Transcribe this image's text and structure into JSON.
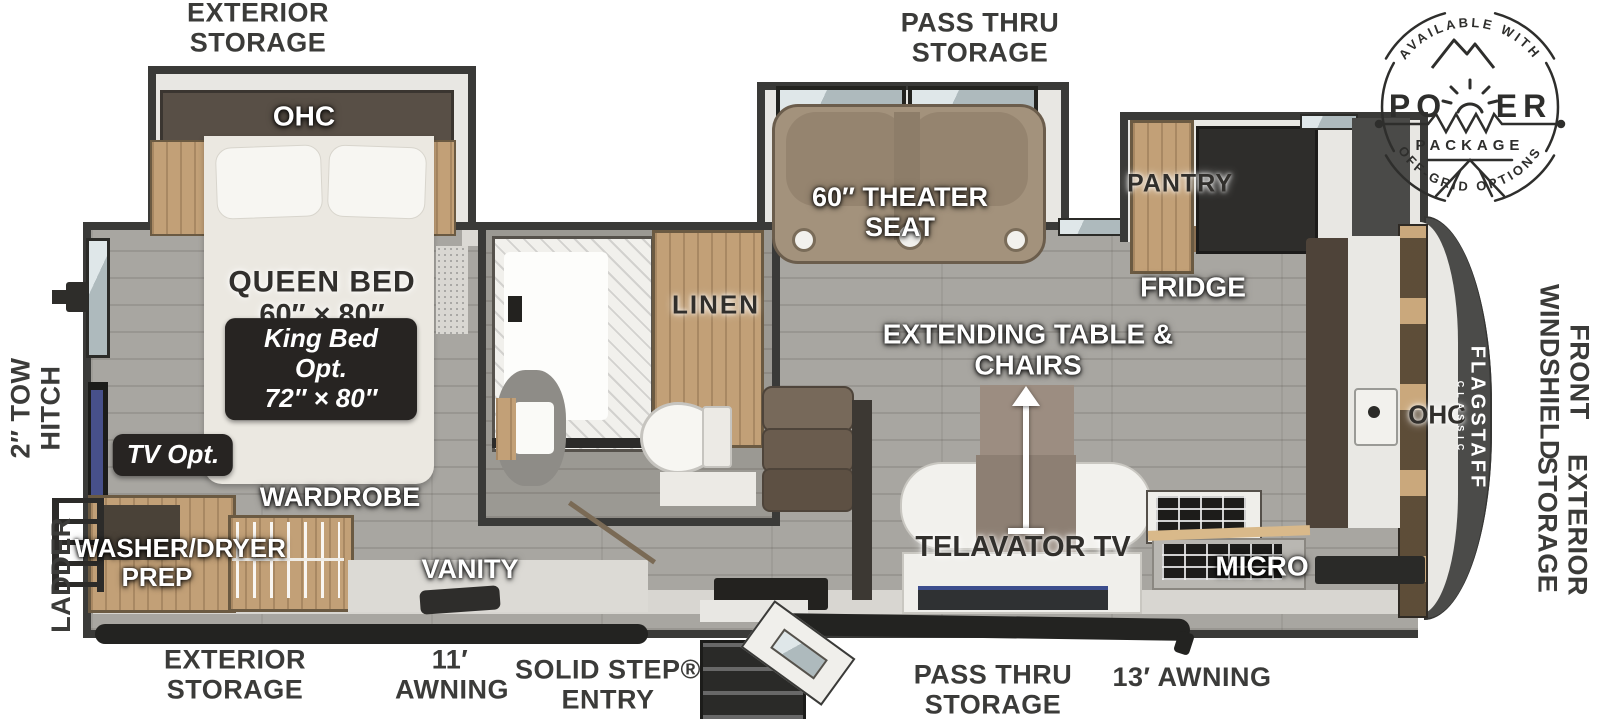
{
  "power_badge": {
    "arc_top": "AVAILABLE WITH",
    "word_left": "PO",
    "word_right": "ER",
    "package": "PACKAGE",
    "arc_bottom": "OFF-GRID OPTIONS"
  },
  "brand": {
    "name": "FLAGSTAFF",
    "series": "CLASSIC"
  },
  "exterior_labels": {
    "storage_top_left": "EXTERIOR STORAGE",
    "pass_thru_top": "PASS THRU STORAGE",
    "tow_hitch": "2″ TOW HITCH",
    "ladder": "LADDER",
    "front_windshield": "FRONT WINDSHIELD",
    "exterior_storage_right": "EXTERIOR STORAGE",
    "exterior_storage_bottom": "EXTERIOR STORAGE",
    "awning_11": "11′ AWNING",
    "solid_step_entry": "SOLID STEP® ENTRY",
    "pass_thru_bottom": "PASS THRU STORAGE",
    "awning_13": "13′ AWNING"
  },
  "bedroom": {
    "ohc": "OHC",
    "bed_name": "QUEEN BED",
    "bed_size": "60″ × 80″",
    "king_option_name": "King Bed Opt.",
    "king_option_size": "72″ × 80″",
    "tv_option": "TV Opt.",
    "wardrobe": "WARDROBE",
    "washer_dryer_prep": "WASHER/DRYER PREP"
  },
  "bathroom": {
    "linen": "LINEN",
    "vanity": "VANITY"
  },
  "living_area": {
    "theater_seat": "60″ THEATER SEAT",
    "extending_table": "EXTENDING TABLE & CHAIRS",
    "telavator_tv": "TELAVATOR TV"
  },
  "kitchen": {
    "pantry": "PANTRY",
    "fridge": "FRIDGE",
    "micro": "MICRO",
    "ohc_front": "OHC"
  },
  "colors": {
    "wall": "#3a3a38",
    "label_text": "#3b3b39",
    "wood_cabinet": "#c2a077",
    "floor_gray": "#a8a6a1",
    "badge_dark": "#272422",
    "theater_tan": "#a3927c",
    "front_cap": "#4b4b49",
    "tv_screen": "#47508a"
  }
}
